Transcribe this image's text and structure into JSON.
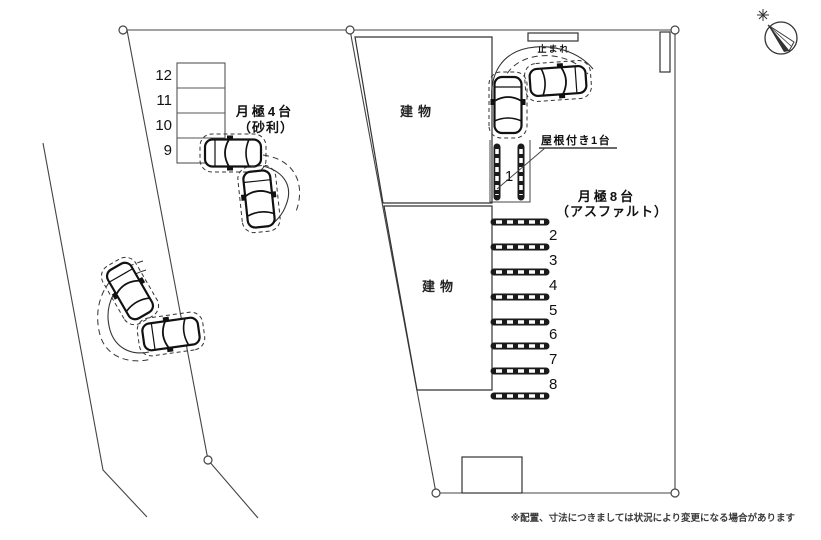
{
  "diagram": {
    "left_lot": {
      "name": "月極4台",
      "surface": "（砂利）",
      "stall_numbers": [
        "12",
        "11",
        "10",
        "9"
      ]
    },
    "right_lot": {
      "name": "月極8台",
      "surface": "（アスファルト）",
      "stall_numbers": [
        "2",
        "3",
        "4",
        "5",
        "6",
        "7",
        "8"
      ],
      "covered_stall": {
        "number": "1",
        "label": "屋根付き1台"
      }
    },
    "buildings": [
      {
        "label": "建物"
      },
      {
        "label": "建物"
      }
    ],
    "signs": {
      "stop": "止まれ"
    },
    "footnote": "※配置、寸法につきましては状況により変更になる場合があります",
    "compass": "north-arrow",
    "colors": {
      "line": "#444444",
      "text": "#111111",
      "bar": "#1a1a1a"
    }
  }
}
